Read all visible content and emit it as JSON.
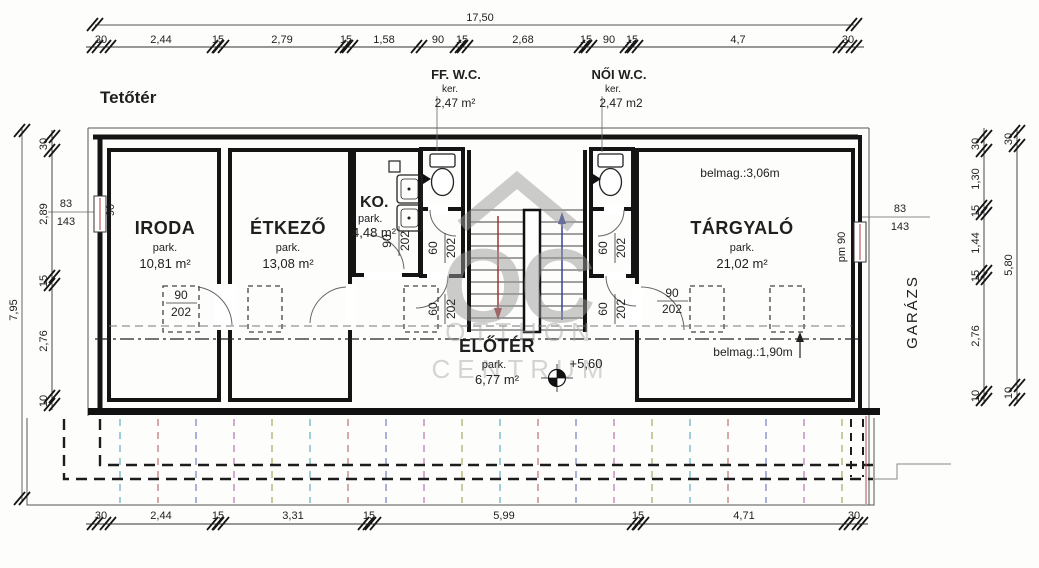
{
  "drawing": {
    "floor_title": "Tetőtér",
    "total_width": "17,50",
    "total_height_left": "7,95"
  },
  "dims": {
    "top": [
      "30",
      "2,44",
      "15",
      "2,79",
      "15",
      "1,58",
      "90",
      "15",
      "2,68",
      "15",
      "90",
      "15",
      "4,7",
      "30"
    ],
    "bottom": [
      "30",
      "2,44",
      "15",
      "3,31",
      "15",
      "5,99",
      "15",
      "4,71",
      "30"
    ],
    "left": [
      "30",
      "2,89",
      "15",
      "2,76",
      "10"
    ],
    "right_inner": [
      "30",
      "1,30",
      "15",
      "1,44",
      "15",
      "2,76",
      "10"
    ],
    "right_outer": [
      "30",
      "5,80",
      "10"
    ]
  },
  "rooms": {
    "iroda": {
      "name": "IRODA",
      "park": "park.",
      "area": "10,81 m²"
    },
    "etkezo": {
      "name": "ÉTKEZŐ",
      "park": "park.",
      "area": "13,08 m²"
    },
    "ko": {
      "name": "KO.",
      "park": "park.",
      "area": "4,48 m²"
    },
    "targyalo": {
      "name": "TÁRGYALÓ",
      "park": "park.",
      "area": "21,02 m²"
    },
    "eloter": {
      "name": "ELŐTÉR",
      "park": "park.",
      "area": "6,77 m²"
    },
    "ff_wc": {
      "name": "FF. W.C.",
      "ker": "ker.",
      "area": "2,47 m²"
    },
    "noi_wc": {
      "name": "NŐI W.C.",
      "ker": "ker.",
      "area": "2,47 m2"
    },
    "garazs": {
      "name": "GARÁZS"
    }
  },
  "annotations": {
    "belmag_top": "belmag.:3,06m",
    "belmag_low": "belmag.:1,90m",
    "level": "+5,60",
    "win_left_w": "83",
    "win_left_h": "143",
    "win_left_size": "90",
    "win_right_w": "83",
    "win_right_h": "143",
    "win_right_size": "pm 90",
    "door_90": "90",
    "door_202": "202",
    "door_60": "60"
  },
  "watermark": {
    "logo": "OC",
    "line1": "OTTHON",
    "line2": "CENTRUM"
  }
}
